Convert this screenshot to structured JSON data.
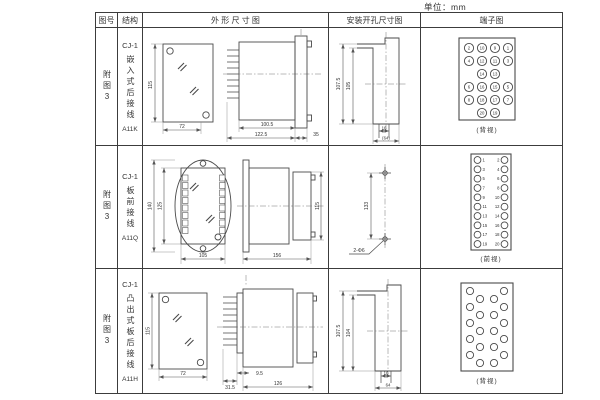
{
  "unit_label": "单位：mm",
  "table": {
    "headers": {
      "fig_no": "图号",
      "structure": "结构",
      "outline": "外 形 尺 寸 图",
      "mounting": "安装开孔尺寸图",
      "terminal": "端子图"
    },
    "rows": [
      {
        "fig_no": "附图3",
        "model": "CJ-1",
        "structure": "嵌入式后接线",
        "code": "A11K",
        "outline_dims": {
          "front_h": "115",
          "front_w": "72",
          "body_l": "100.5",
          "total_l": "122.5",
          "flange": "35"
        },
        "mounting_dims": {
          "outer_h": "107.5",
          "inner_h": "105",
          "slot_w": "16",
          "cutout_w": "(64)"
        },
        "terminal": {
          "view_label": "(背视)",
          "rows": [
            [
              "2",
              "10",
              "9",
              "1"
            ],
            [
              "4",
              "12",
              "11",
              "3"
            ],
            [
              "14",
              "13"
            ],
            [
              "6",
              "16",
              "15",
              "5"
            ],
            [
              "8",
              "18",
              "17",
              "7"
            ],
            [
              "20",
              "19"
            ]
          ]
        }
      },
      {
        "fig_no": "附图3",
        "model": "CJ-1",
        "structure": "板前接线",
        "code": "A11Q",
        "outline_dims": {
          "outer_h": "140",
          "inner_h": "125",
          "front_w": "105",
          "total_l": "156",
          "side_h": "115"
        },
        "mounting_dims": {
          "hole_span": "133",
          "holes": "2-Φ6"
        },
        "terminal": {
          "view_label": "(前视)",
          "left": [
            "1",
            "3",
            "5",
            "7",
            "9",
            "11",
            "13",
            "15",
            "17",
            "19"
          ],
          "right": [
            "2",
            "4",
            "6",
            "8",
            "10",
            "12",
            "14",
            "16",
            "18",
            "20"
          ]
        }
      },
      {
        "fig_no": "附图3",
        "model": "CJ-1",
        "structure": "凸出式板后接线",
        "code": "A11H",
        "outline_dims": {
          "front_h": "115",
          "front_w": "72",
          "pin_l": "31.5",
          "gap": "9.5",
          "body_l": "126"
        },
        "mounting_dims": {
          "outer_h": "107.5",
          "inner_h": "104",
          "slot_w": "16",
          "cutout_w": "64"
        },
        "terminal": {
          "view_label": "(背视)"
        }
      }
    ]
  }
}
